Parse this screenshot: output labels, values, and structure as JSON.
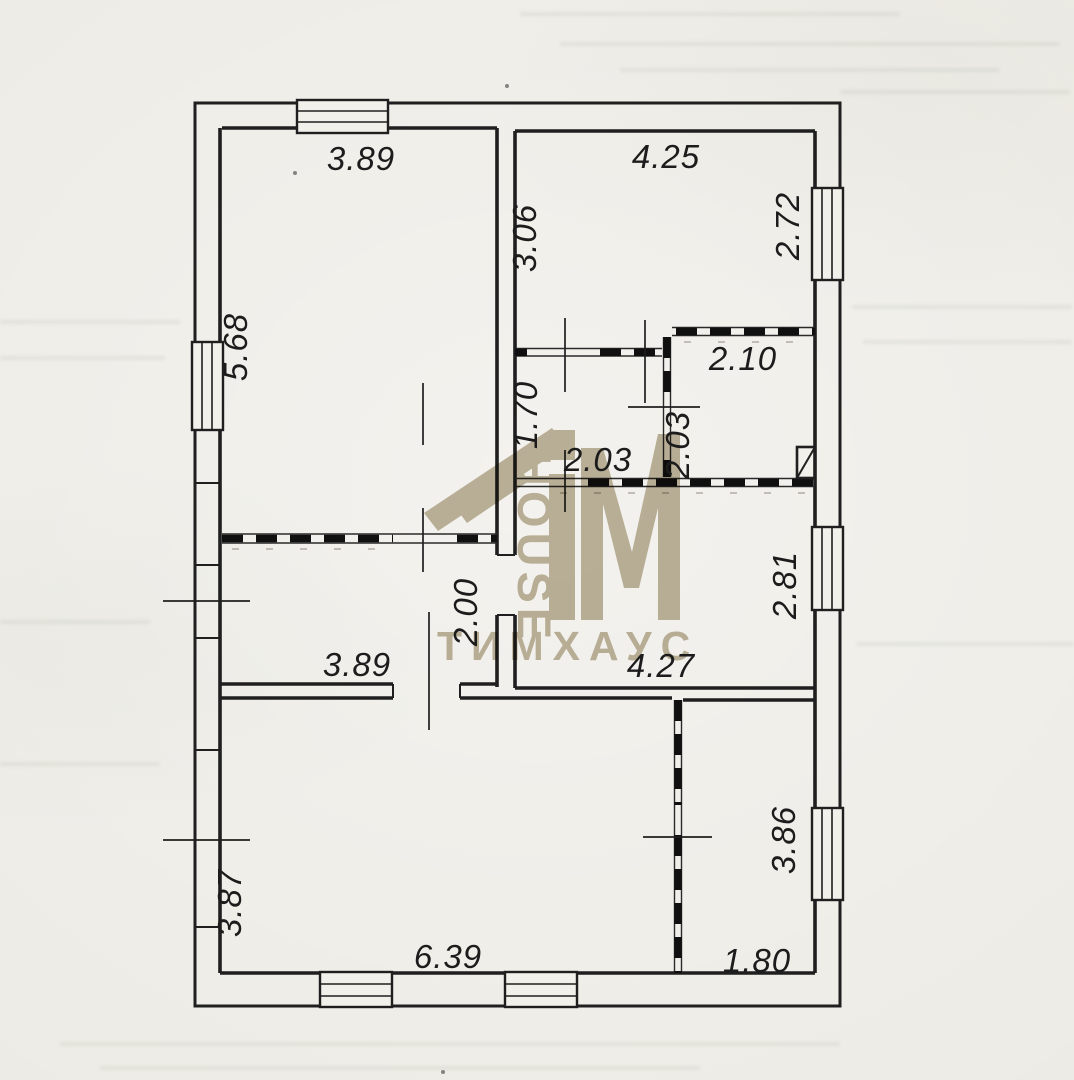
{
  "document": {
    "kind": "scanned floor plan (technical passport drawing)",
    "units": "m"
  },
  "watermark": {
    "monogram": "TiM",
    "vertical_text": "HOUSE",
    "brand_text": "ТИМХАУС",
    "color": "#b4a78b"
  },
  "plan": {
    "line_color": "#1f1f1f",
    "paper_color": "#edebe5"
  },
  "dimensions": {
    "room_top_left": {
      "width": "3.89",
      "height": "5.68"
    },
    "room_top_right": {
      "width": "4.25",
      "height_left": "3.06",
      "height_right": "2.72"
    },
    "bathroom": {
      "width": "2.10",
      "height": "2.03"
    },
    "hall_right": {
      "width": "2.03",
      "height": "1.70"
    },
    "room_mid_right": {
      "width": "4.27",
      "height": "2.81"
    },
    "hall_left": {
      "width": "3.89",
      "height": "2.00"
    },
    "room_bottom_left": {
      "width": "6.39",
      "height": "3.87"
    },
    "room_bottom_right": {
      "width": "1.80",
      "height": "3.86"
    }
  }
}
